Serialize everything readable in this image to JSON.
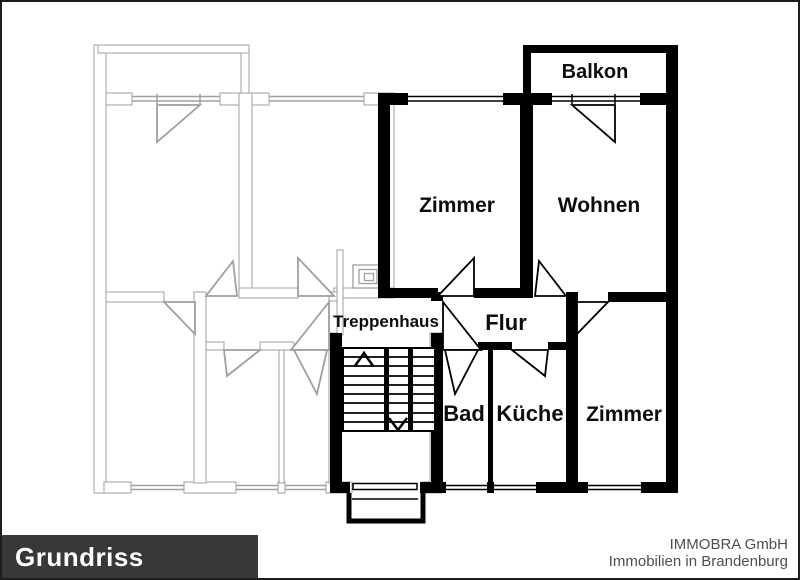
{
  "rooms": {
    "balkon": "Balkon",
    "zimmer_top": "Zimmer",
    "wohnen": "Wohnen",
    "treppenhaus": "Treppenhaus",
    "flur": "Flur",
    "bad": "Bad",
    "kueche": "Küche",
    "zimmer_bottom": "Zimmer"
  },
  "footer": {
    "title": "Grundriss",
    "company_name": "IMMOBRA GmbH",
    "company_location": "Immobilien in Brandenburg"
  },
  "colors": {
    "wall": "#000000",
    "ghost": "#9f9f9f",
    "footer_bar": "#38383a",
    "footer_title": "#ffffff",
    "company_text": "#4f4f4f"
  }
}
